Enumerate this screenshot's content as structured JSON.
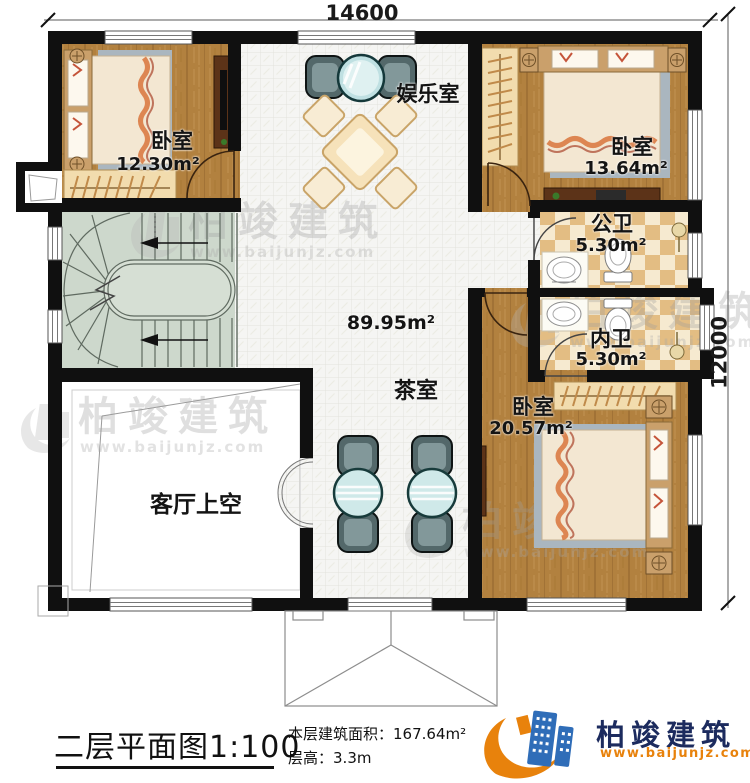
{
  "dimensions": {
    "top": "14600",
    "right": "12000"
  },
  "rooms": {
    "bedroom_top_left": {
      "name": "卧室",
      "area": "12.30m²"
    },
    "entertainment_room": {
      "name": "娱乐室"
    },
    "bedroom_top_right": {
      "name": "卧室",
      "area": "13.64m²"
    },
    "public_bathroom": {
      "name": "公卫",
      "area": "5.30m²"
    },
    "ensuite_bathroom": {
      "name": "内卫",
      "area": "5.30m²"
    },
    "hall": {
      "area": "89.95m²"
    },
    "tea_room": {
      "name": "茶室"
    },
    "bedroom_bottom": {
      "name": "卧室",
      "area": "20.57m²"
    },
    "living_room_void": {
      "name": "客厅上空"
    }
  },
  "footer": {
    "plan_title": "二层平面图",
    "plan_scale": "1:100",
    "floor_area_label": "本层建筑面积：",
    "floor_area_value": "167.64m²",
    "floor_height_label": "层高：",
    "floor_height_value": "3.3m"
  },
  "brand": {
    "name": "柏竣建筑",
    "website": "www.baijunjz.com"
  },
  "watermark": {
    "name": "柏竣建筑",
    "website": "www.baijunjz.com"
  },
  "colors": {
    "wall": "#101010",
    "wood_floor": "#b2813f",
    "tile_floor": "#f5f5f3",
    "stair_floor": "#cdd8cc",
    "bath_tile_dark": "#e3bd83",
    "bath_tile_light": "#f6ead0",
    "brand_blue": "#2f6db8",
    "brand_navy": "#1c2b5e",
    "brand_orange": "#e8820c"
  }
}
